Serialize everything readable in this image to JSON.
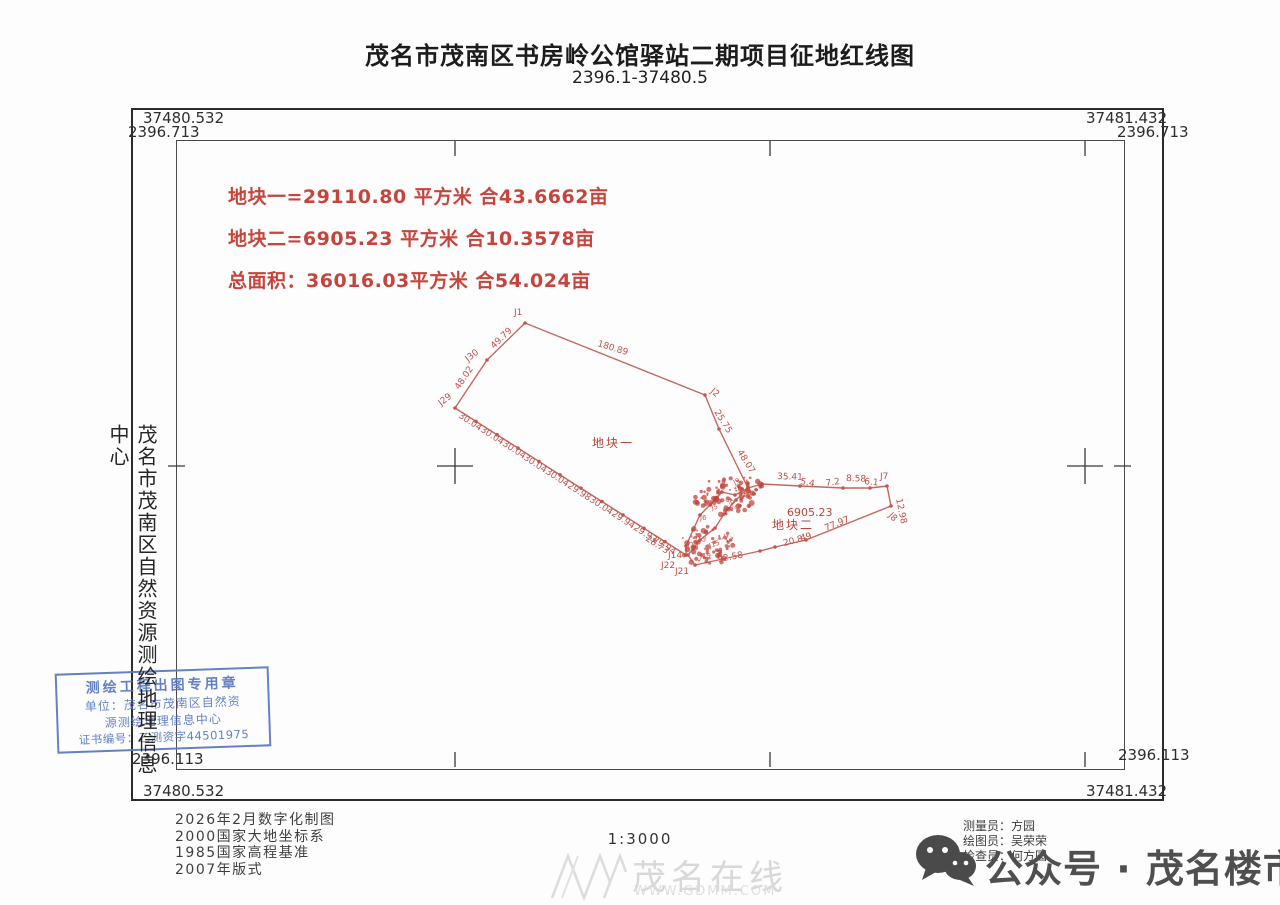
{
  "title": {
    "main": "茂名市茂南区书房岭公馆驿站二期项目征地红线图",
    "sub": "2396.1-37480.5"
  },
  "frame_labels": {
    "tl_n": "37480.532",
    "tl_e": "2396.713",
    "tr_n": "37481.432",
    "tr_e": "2396.713",
    "bl_e": "2396.113",
    "bl_n": "37480.532",
    "br_e": "2396.113",
    "br_n": "37481.432"
  },
  "area_summary": {
    "color": "#c5453d",
    "lines": [
      "地块一=29110.80 平方米 合43.6662亩",
      "地块二=6905.23 平方米 合10.3578亩",
      "总面积：36016.03平方米 合54.024亩"
    ]
  },
  "agency_vertical": "茂名市茂南区自然资源测绘地理信息中心",
  "stamp": {
    "color": "#5877c2",
    "lines": [
      "测绘工程出图专用章",
      "单位：茂名市茂南区自然资",
      "源测绘地理信息中心",
      "证书编号：乙测资字44501975"
    ]
  },
  "footer": {
    "notes": [
      "2026年2月数字化制图",
      "2000国家大地坐标系",
      "1985国家高程基准",
      "2007年版式"
    ],
    "scale": "1:3000",
    "staff": [
      "测量员：方园",
      "绘图员：吴荣荣",
      "检查员：何方园"
    ]
  },
  "watermark": {
    "name": "茂名在线",
    "url": "WWW.GDMM.COM"
  },
  "wechat": {
    "label": "公众号 · 茂名楼市"
  },
  "map_data": {
    "type": "parcel-map",
    "scale": "1:3000",
    "line_color": "#c4675f",
    "ticks": {
      "top": [
        455,
        770,
        1085
      ],
      "bottom": [
        455,
        770,
        1085
      ],
      "left": [
        466
      ],
      "right": [
        466
      ]
    },
    "crosses": [
      [
        455,
        466
      ],
      [
        1085,
        466
      ]
    ],
    "parcel1": {
      "name": "地块一",
      "area_sqm": 29110.8,
      "area_mu": 43.6662,
      "outline": [
        [
          525,
          323
        ],
        [
          705,
          395
        ],
        [
          719,
          429
        ],
        [
          748,
          488
        ],
        [
          735,
          495
        ],
        [
          722,
          492
        ],
        [
          710,
          505
        ],
        [
          700,
          515
        ],
        [
          693,
          530
        ],
        [
          686,
          546
        ],
        [
          686,
          555
        ],
        [
          455,
          408
        ],
        [
          487,
          360
        ]
      ],
      "label_pos": [
        592,
        447
      ]
    },
    "parcel2": {
      "name": "地块二",
      "area_sqm": 6905.23,
      "area_mu": 10.3578,
      "area_label": "6905.23",
      "outline": [
        [
          748,
          488
        ],
        [
          762,
          484
        ],
        [
          800,
          486
        ],
        [
          843,
          488
        ],
        [
          870,
          488
        ],
        [
          887,
          486
        ],
        [
          891,
          506
        ],
        [
          806,
          540
        ],
        [
          775,
          547
        ],
        [
          760,
          551
        ],
        [
          695,
          565
        ],
        [
          688,
          555
        ],
        [
          700,
          540
        ],
        [
          715,
          528
        ],
        [
          724,
          514
        ],
        [
          736,
          500
        ]
      ],
      "label_pos": [
        772,
        529
      ],
      "area_label_pos": [
        787,
        516
      ]
    },
    "edge_dots": [
      {
        "from": [
          455,
          408
        ],
        "to": [
          686,
          555
        ],
        "n": 10
      }
    ],
    "labels": [
      {
        "t": "J1",
        "x": 514,
        "y": 315,
        "r": 0
      },
      {
        "t": "180.89",
        "x": 597,
        "y": 346,
        "r": 17
      },
      {
        "t": "J2",
        "x": 710,
        "y": 392,
        "r": 40
      },
      {
        "t": "25.75",
        "x": 714,
        "y": 412,
        "r": 58
      },
      {
        "t": "48.07",
        "x": 737,
        "y": 452,
        "r": 58
      },
      {
        "t": "J30",
        "x": 468,
        "y": 362,
        "r": -38
      },
      {
        "t": "49.79",
        "x": 494,
        "y": 349,
        "r": -44
      },
      {
        "t": "48.02",
        "x": 459,
        "y": 390,
        "r": -56
      },
      {
        "t": "J29",
        "x": 441,
        "y": 406,
        "r": -38
      },
      {
        "t": "30.04",
        "x": 458,
        "y": 417,
        "r": 33
      },
      {
        "t": "30.04",
        "x": 480,
        "y": 431,
        "r": 33
      },
      {
        "t": "30.04",
        "x": 502,
        "y": 445,
        "r": 33
      },
      {
        "t": "30.04",
        "x": 523,
        "y": 459,
        "r": 33
      },
      {
        "t": "30.04",
        "x": 545,
        "y": 473,
        "r": 33
      },
      {
        "t": "29.98",
        "x": 567,
        "y": 487,
        "r": 33
      },
      {
        "t": "30.04",
        "x": 589,
        "y": 501,
        "r": 33
      },
      {
        "t": "29.94",
        "x": 611,
        "y": 515,
        "r": 33
      },
      {
        "t": "29.93",
        "x": 633,
        "y": 529,
        "r": 33
      },
      {
        "t": "29.94",
        "x": 652,
        "y": 541,
        "r": 33
      },
      {
        "t": "28.73",
        "x": 645,
        "y": 540,
        "r": 33
      },
      {
        "t": "J14",
        "x": 668,
        "y": 558,
        "r": 0
      },
      {
        "t": "35.41",
        "x": 777,
        "y": 479,
        "r": 2
      },
      {
        "t": "5.4",
        "x": 800,
        "y": 484,
        "r": 10
      },
      {
        "t": "7.2",
        "x": 826,
        "y": 486,
        "r": -8
      },
      {
        "t": "8.58",
        "x": 846,
        "y": 481,
        "r": 2
      },
      {
        "t": "6.1",
        "x": 864,
        "y": 484,
        "r": 6
      },
      {
        "t": "J7",
        "x": 880,
        "y": 479,
        "r": 0
      },
      {
        "t": "12.98",
        "x": 896,
        "y": 499,
        "r": 78
      },
      {
        "t": "J8",
        "x": 888,
        "y": 516,
        "r": 45
      },
      {
        "t": "77.97",
        "x": 826,
        "y": 531,
        "r": -22
      },
      {
        "t": "49",
        "x": 801,
        "y": 541,
        "r": -14
      },
      {
        "t": "20.8",
        "x": 784,
        "y": 546,
        "r": -14
      },
      {
        "t": "92.58",
        "x": 718,
        "y": 562,
        "r": -10
      },
      {
        "t": "J21",
        "x": 675,
        "y": 574,
        "r": 0
      },
      {
        "t": "J22",
        "x": 661,
        "y": 568,
        "r": 0
      }
    ],
    "clusters": [
      {
        "cx": 724,
        "cy": 497,
        "rx": 30,
        "ry": 20,
        "n": 70
      },
      {
        "cx": 707,
        "cy": 546,
        "rx": 28,
        "ry": 20,
        "n": 60
      },
      {
        "cx": 748,
        "cy": 486,
        "rx": 14,
        "ry": 10,
        "n": 20
      }
    ],
    "cluster_labels": [
      {
        "t": "J3",
        "x": 741,
        "y": 492,
        "r": 20
      },
      {
        "t": "J5",
        "x": 712,
        "y": 510,
        "r": -15
      },
      {
        "t": "J6",
        "x": 700,
        "y": 520,
        "r": 0
      },
      {
        "t": "30.0",
        "x": 725,
        "y": 500,
        "r": 40
      },
      {
        "t": "J9",
        "x": 735,
        "y": 485,
        "r": -30
      },
      {
        "t": "J13",
        "x": 695,
        "y": 540,
        "r": 10
      },
      {
        "t": "J15",
        "x": 710,
        "y": 548,
        "r": -20
      },
      {
        "t": "J17",
        "x": 722,
        "y": 538,
        "r": 25
      },
      {
        "t": "J19",
        "x": 700,
        "y": 558,
        "r": 0
      },
      {
        "t": "J23",
        "x": 688,
        "y": 548,
        "r": -10
      }
    ]
  }
}
